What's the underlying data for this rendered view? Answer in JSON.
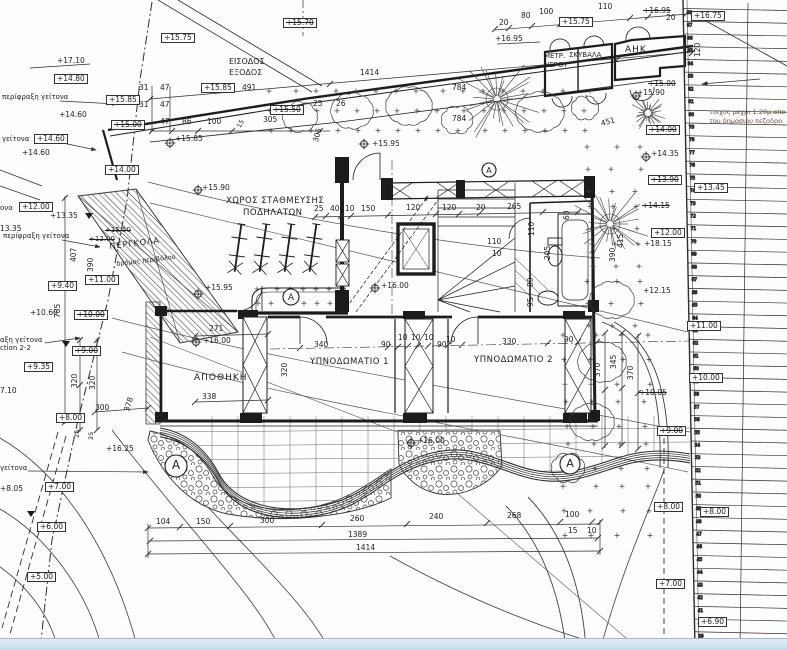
{
  "drawing": {
    "type": "architectural-site-plan",
    "language": "Greek",
    "rooms": {
      "storage": "ΑΠΟΘΗΚΗ",
      "bedroom1": "ΥΠΝΟΔΩΜΑΤΙΟ 1",
      "bedroom2": "ΥΠΝΟΔΩΜΑΤΙΟ 2",
      "bike_parking_line1": "ΧΩΡΟΣ ΣΤΑΘΜΕΥΣΗΣ",
      "bike_parking_line2": "ΠΟΔΗΛΑΤΩΝ",
      "entrance_line1": "ΕΙΣΟΔΟΣ",
      "entrance_line2": "ΕΞΟΔΟΣ",
      "electricity": "ΑΗΚ",
      "meters": "ΜΕΤΡ. ΝΕΡΟΥ / ΣΚΥΒΑΛΑ",
      "pergola": "ΠΕΡΓΚΟΛΑ"
    },
    "notes": [
      "τοιχος μεχρι 1.20μ απο",
      "του δημοσιου πεζοδρο",
      "περίφραξη γείτονα",
      "δρόμος περιβόλου",
      "Section 2-2"
    ]
  },
  "colors": {
    "paper": "#fdfdfb",
    "ink": "#2e2e2e",
    "bar": "#c9daee",
    "note": "#6a4a42"
  },
  "labels": [
    {
      "t": "+17.10",
      "x": 57,
      "y": 57
    },
    {
      "t": "+14.80",
      "x": 54,
      "y": 74,
      "b": 1
    },
    {
      "t": "περίφραξη γείτονα",
      "x": 2,
      "y": 94,
      "s": 7
    },
    {
      "t": "+15.75",
      "x": 161,
      "y": 33,
      "b": 1
    },
    {
      "t": "+15.85",
      "x": 201,
      "y": 83,
      "b": 1
    },
    {
      "t": "+15.85",
      "x": 106,
      "y": 95,
      "b": 1
    },
    {
      "t": "+15.00",
      "x": 111,
      "y": 120,
      "b": 1,
      "c": 1
    },
    {
      "t": "+15.70",
      "x": 283,
      "y": 18,
      "b": 1,
      "c": 1
    },
    {
      "t": "ΕΙΣΟΔΟΣ",
      "x": 229,
      "y": 58,
      "s": 8
    },
    {
      "t": "ΕΞΟΔΟΣ",
      "x": 229,
      "y": 69,
      "s": 8
    },
    {
      "t": "491",
      "x": 242,
      "y": 84
    },
    {
      "t": "31",
      "x": 139,
      "y": 84
    },
    {
      "t": "47",
      "x": 160,
      "y": 84
    },
    {
      "t": "31",
      "x": 139,
      "y": 101
    },
    {
      "t": "47",
      "x": 160,
      "y": 101
    },
    {
      "t": "47",
      "x": 160,
      "y": 118
    },
    {
      "t": "86",
      "x": 182,
      "y": 118
    },
    {
      "t": "100",
      "x": 207,
      "y": 118
    },
    {
      "t": "305",
      "x": 263,
      "y": 116
    },
    {
      "t": "+15.50",
      "x": 270,
      "y": 105,
      "b": 1,
      "c": 1
    },
    {
      "t": "15",
      "x": 236,
      "y": 126,
      "r": -62,
      "s": 6.5
    },
    {
      "t": "305",
      "x": 312,
      "y": 141,
      "r": -75
    },
    {
      "t": "25",
      "x": 313,
      "y": 100
    },
    {
      "t": "26",
      "x": 336,
      "y": 100
    },
    {
      "t": "1414",
      "x": 360,
      "y": 69
    },
    {
      "t": "784",
      "x": 452,
      "y": 84
    },
    {
      "t": "784",
      "x": 452,
      "y": 115
    },
    {
      "t": "+16.95",
      "x": 495,
      "y": 35
    },
    {
      "t": "20",
      "x": 499,
      "y": 19
    },
    {
      "t": "80",
      "x": 521,
      "y": 12
    },
    {
      "t": "100",
      "x": 539,
      "y": 8
    },
    {
      "t": "110",
      "x": 598,
      "y": 3
    },
    {
      "t": "20",
      "x": 666,
      "y": 14
    },
    {
      "t": "+15.75",
      "x": 559,
      "y": 17,
      "b": 1
    },
    {
      "t": "+16.95",
      "x": 643,
      "y": 7,
      "c": 1
    },
    {
      "t": "+16.75",
      "x": 691,
      "y": 11,
      "b": 1
    },
    {
      "t": "ΜΕΤΡ.",
      "x": 544,
      "y": 53,
      "s": 7
    },
    {
      "t": "ΣΚΥΒΑΛΑ",
      "x": 569,
      "y": 52,
      "s": 7
    },
    {
      "t": "ΝΕΡΟΥ",
      "x": 544,
      "y": 62,
      "s": 7
    },
    {
      "t": "ΑΗΚ",
      "x": 625,
      "y": 46,
      "s": 9,
      "ls": 1
    },
    {
      "t": "120",
      "x": 694,
      "y": 57,
      "r": -90
    },
    {
      "t": "τοιχος μεχρι 1.20μ απο",
      "x": 709,
      "y": 109,
      "s": 6.5,
      "col": "#6a4a42"
    },
    {
      "t": "του δημοσιου πεζοδρο",
      "x": 709,
      "y": 118,
      "s": 6.5,
      "col": "#6a4a42"
    },
    {
      "t": "+15.00",
      "x": 648,
      "y": 80,
      "c": 1
    },
    {
      "t": "+15.90",
      "x": 637,
      "y": 89
    },
    {
      "t": "451",
      "x": 600,
      "y": 120,
      "r": -14
    },
    {
      "t": "+14.60",
      "x": 59,
      "y": 111
    },
    {
      "t": "γείτονα",
      "x": 2,
      "y": 136,
      "s": 7
    },
    {
      "t": "+14.60",
      "x": 34,
      "y": 134,
      "b": 1
    },
    {
      "t": "+14.60",
      "x": 22,
      "y": 149
    },
    {
      "t": "+14.00",
      "x": 105,
      "y": 165,
      "b": 1
    },
    {
      "t": "+15.85",
      "x": 175,
      "y": 135
    },
    {
      "t": "+15.90",
      "x": 202,
      "y": 184
    },
    {
      "t": "+14.00",
      "x": 646,
      "y": 125,
      "b": 1,
      "c": 1
    },
    {
      "t": "+14.35",
      "x": 651,
      "y": 150
    },
    {
      "t": "+13.90",
      "x": 648,
      "y": 175,
      "b": 1,
      "c": 1
    },
    {
      "t": "+13.45",
      "x": 694,
      "y": 183,
      "b": 1
    },
    {
      "t": "+14.15",
      "x": 642,
      "y": 202,
      "c": 1
    },
    {
      "t": "+12.00",
      "x": 651,
      "y": 228,
      "b": 1
    },
    {
      "t": "+18.15",
      "x": 644,
      "y": 240
    },
    {
      "t": "+12.15",
      "x": 643,
      "y": 287
    },
    {
      "t": "415",
      "x": 617,
      "y": 248,
      "r": -90
    },
    {
      "t": "390",
      "x": 609,
      "y": 262,
      "r": -90
    },
    {
      "t": "ΧΩΡΟΣ ΣΤΑΘΜΕΥΣΗΣ",
      "x": 226,
      "y": 197,
      "s": 8.5,
      "ls": 0.5
    },
    {
      "t": "ΠΟΔΗΛΑΤΩΝ",
      "x": 243,
      "y": 209,
      "s": 8.5,
      "ls": 0.5
    },
    {
      "t": "25",
      "x": 314,
      "y": 205
    },
    {
      "t": "40",
      "x": 330,
      "y": 205
    },
    {
      "t": "10",
      "x": 345,
      "y": 205
    },
    {
      "t": "150",
      "x": 361,
      "y": 205
    },
    {
      "t": "120",
      "x": 406,
      "y": 204
    },
    {
      "t": "120",
      "x": 442,
      "y": 204
    },
    {
      "t": "20",
      "x": 476,
      "y": 204
    },
    {
      "t": "265",
      "x": 507,
      "y": 203
    },
    {
      "t": "60",
      "x": 563,
      "y": 220,
      "r": -90
    },
    {
      "t": "110",
      "x": 528,
      "y": 236,
      "r": -90
    },
    {
      "t": "110",
      "x": 487,
      "y": 238
    },
    {
      "t": "10",
      "x": 492,
      "y": 250
    },
    {
      "t": "205",
      "x": 544,
      "y": 260,
      "r": -90
    },
    {
      "t": "80",
      "x": 527,
      "y": 287,
      "r": -90
    },
    {
      "t": "95",
      "x": 527,
      "y": 307,
      "r": -90
    },
    {
      "t": "+15.95",
      "x": 372,
      "y": 140
    },
    {
      "t": "+16.00",
      "x": 381,
      "y": 282
    },
    {
      "t": "+15.95",
      "x": 205,
      "y": 284
    },
    {
      "t": "ονα",
      "x": 0,
      "y": 205,
      "s": 7
    },
    {
      "t": "+12.00",
      "x": 19,
      "y": 202,
      "b": 1
    },
    {
      "t": "+13.35",
      "x": 50,
      "y": 212
    },
    {
      "t": "13.35",
      "x": 0,
      "y": 225
    },
    {
      "t": "περίφραξη γείτονα",
      "x": 3,
      "y": 233,
      "s": 7
    },
    {
      "t": "+15.50",
      "x": 105,
      "y": 227,
      "c": 1,
      "s": 7
    },
    {
      "t": "+12.00",
      "x": 89,
      "y": 236,
      "c": 1,
      "s": 7
    },
    {
      "t": "ΠΕΡΓΚΟΛΑ",
      "x": 109,
      "y": 243,
      "s": 8,
      "r": -7,
      "ls": 1
    },
    {
      "t": "δρόμος περιβόλου",
      "x": 116,
      "y": 261,
      "s": 6.5,
      "r": -7
    },
    {
      "t": "407",
      "x": 70,
      "y": 262,
      "r": -90
    },
    {
      "t": "390",
      "x": 87,
      "y": 272,
      "r": -90
    },
    {
      "t": "+11.00",
      "x": 85,
      "y": 275,
      "b": 1
    },
    {
      "t": "+9.40",
      "x": 48,
      "y": 281,
      "b": 1
    },
    {
      "t": "785",
      "x": 54,
      "y": 318,
      "r": -90
    },
    {
      "t": "+10.60",
      "x": 30,
      "y": 309
    },
    {
      "t": "+10.00",
      "x": 74,
      "y": 310,
      "b": 1,
      "c": 1
    },
    {
      "t": "αξη γείτονα",
      "x": 0,
      "y": 337,
      "s": 7
    },
    {
      "t": "ction 2-2",
      "x": 0,
      "y": 345,
      "s": 7
    },
    {
      "t": "+9.00",
      "x": 72,
      "y": 346,
      "b": 1,
      "c": 1
    },
    {
      "t": "+9.35",
      "x": 24,
      "y": 362,
      "b": 1
    },
    {
      "t": "320",
      "x": 71,
      "y": 388,
      "r": -90
    },
    {
      "t": "320",
      "x": 89,
      "y": 390,
      "r": -90
    },
    {
      "t": "7.10",
      "x": 0,
      "y": 387
    },
    {
      "t": "378",
      "x": 123,
      "y": 410,
      "r": -72
    },
    {
      "t": "300",
      "x": 95,
      "y": 404
    },
    {
      "t": "+8.00",
      "x": 56,
      "y": 413,
      "b": 1
    },
    {
      "t": "25",
      "x": 74,
      "y": 438,
      "r": -90,
      "s": 6.5
    },
    {
      "t": "25",
      "x": 88,
      "y": 440,
      "r": -90,
      "s": 6.5
    },
    {
      "t": "γείτονα",
      "x": 0,
      "y": 465,
      "s": 7
    },
    {
      "t": "+16.25",
      "x": 106,
      "y": 445
    },
    {
      "t": "+8.05",
      "x": 0,
      "y": 485
    },
    {
      "t": "+7.00",
      "x": 45,
      "y": 482,
      "b": 1
    },
    {
      "t": "+6.00",
      "x": 37,
      "y": 522,
      "b": 1
    },
    {
      "t": "+5.00",
      "x": 27,
      "y": 572,
      "b": 1
    },
    {
      "t": "ΑΠΟΘΗΚΗ",
      "x": 194,
      "y": 374,
      "s": 9,
      "ls": 1
    },
    {
      "t": "271",
      "x": 209,
      "y": 325
    },
    {
      "t": "+16.00",
      "x": 203,
      "y": 337
    },
    {
      "t": "338",
      "x": 202,
      "y": 393
    },
    {
      "t": "ΥΠΝΟΔΩΜΑΤΙΟ 1",
      "x": 310,
      "y": 358,
      "s": 8.5,
      "ls": 0.5
    },
    {
      "t": "ΥΠΝΟΔΩΜΑΤΙΟ 2",
      "x": 474,
      "y": 356,
      "s": 8.5,
      "ls": 0.5
    },
    {
      "t": "340",
      "x": 314,
      "y": 341
    },
    {
      "t": "90",
      "x": 381,
      "y": 341
    },
    {
      "t": "10",
      "x": 398,
      "y": 334
    },
    {
      "t": "10",
      "x": 411,
      "y": 334
    },
    {
      "t": "10",
      "x": 424,
      "y": 334
    },
    {
      "t": "90",
      "x": 437,
      "y": 341
    },
    {
      "t": "320",
      "x": 281,
      "y": 377,
      "r": -90
    },
    {
      "t": "10",
      "x": 446,
      "y": 336
    },
    {
      "t": "330",
      "x": 502,
      "y": 338
    },
    {
      "t": "90",
      "x": 564,
      "y": 336
    },
    {
      "t": "345",
      "x": 610,
      "y": 369,
      "r": -90
    },
    {
      "t": "370",
      "x": 594,
      "y": 377,
      "r": -90
    },
    {
      "t": "370",
      "x": 627,
      "y": 380,
      "r": -90
    },
    {
      "t": "+11.00",
      "x": 687,
      "y": 321,
      "b": 1
    },
    {
      "t": "+10.00",
      "x": 689,
      "y": 373,
      "b": 1
    },
    {
      "t": "+10.05",
      "x": 639,
      "y": 389,
      "c": 1
    },
    {
      "t": "+9.00",
      "x": 657,
      "y": 426,
      "b": 1,
      "c": 1
    },
    {
      "t": "+8.00",
      "x": 654,
      "y": 502,
      "b": 1
    },
    {
      "t": "+8.00",
      "x": 700,
      "y": 507,
      "b": 1
    },
    {
      "t": "+7.00",
      "x": 656,
      "y": 579,
      "b": 1
    },
    {
      "t": "+6.90",
      "x": 698,
      "y": 617,
      "b": 1
    },
    {
      "t": "104",
      "x": 156,
      "y": 518
    },
    {
      "t": "150",
      "x": 196,
      "y": 518
    },
    {
      "t": "300",
      "x": 260,
      "y": 517
    },
    {
      "t": "260",
      "x": 350,
      "y": 515
    },
    {
      "t": "240",
      "x": 429,
      "y": 513
    },
    {
      "t": "268",
      "x": 507,
      "y": 512
    },
    {
      "t": "100",
      "x": 565,
      "y": 511
    },
    {
      "t": "15",
      "x": 568,
      "y": 527
    },
    {
      "t": "10",
      "x": 587,
      "y": 527
    },
    {
      "t": "1389",
      "x": 348,
      "y": 531
    },
    {
      "t": "1414",
      "x": 356,
      "y": 544
    },
    {
      "t": "+16.00",
      "x": 417,
      "y": 437
    }
  ],
  "markers": {
    "survey_points": [
      {
        "x": 170,
        "y": 143
      },
      {
        "x": 198,
        "y": 190
      },
      {
        "x": 198,
        "y": 294
      },
      {
        "x": 364,
        "y": 144
      },
      {
        "x": 375,
        "y": 288
      },
      {
        "x": 196,
        "y": 342
      },
      {
        "x": 411,
        "y": 443
      },
      {
        "x": 636,
        "y": 96
      },
      {
        "x": 646,
        "y": 157
      }
    ],
    "circled_letters": [
      {
        "x": 291,
        "y": 297,
        "r": 8,
        "label": "A"
      },
      {
        "x": 489,
        "y": 170,
        "r": 7,
        "label": "A"
      },
      {
        "x": 176,
        "y": 466,
        "r": 11,
        "label": "A"
      },
      {
        "x": 570,
        "y": 464,
        "r": 10,
        "label": "A"
      }
    ],
    "triangles": [
      {
        "x": 89,
        "y": 213
      },
      {
        "x": 66,
        "y": 341
      },
      {
        "x": 31,
        "y": 511
      }
    ]
  },
  "strip": {
    "y0": 8.5,
    "step": 12.72,
    "numbers": [
      88,
      87,
      86,
      85,
      84,
      83,
      82,
      81,
      80,
      79,
      78,
      77,
      76,
      75,
      74,
      73,
      72,
      71,
      70,
      69,
      68,
      67,
      66,
      65,
      64,
      63,
      62,
      61,
      60,
      59,
      58,
      57,
      56,
      55,
      54,
      53,
      52,
      51,
      50,
      49,
      48,
      47,
      46,
      45,
      44,
      43,
      42,
      41,
      40,
      39,
      38
    ]
  }
}
